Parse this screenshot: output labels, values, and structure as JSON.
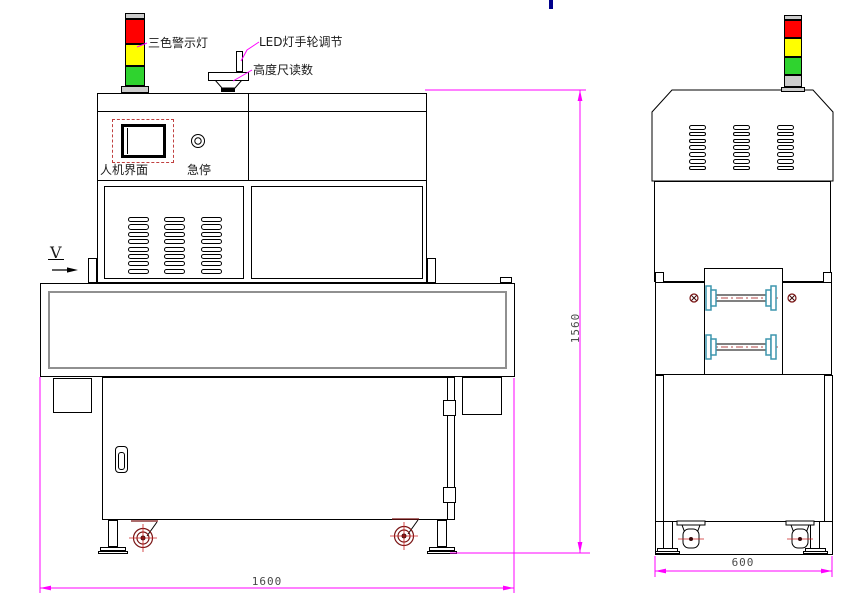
{
  "annotations": {
    "stack_light_label": "三色警示灯",
    "led_handwheel_label": "LED灯手轮调节",
    "height_scale_label": "高度尺读数",
    "hmi_label": "人机界面",
    "estop_label": "急停",
    "view_arrow_label": "V"
  },
  "dimensions": {
    "front_overall_width": "1600",
    "front_overall_height": "1560",
    "side_overall_width": "600"
  },
  "colors": {
    "dimension_line": "#ff00ff",
    "stack_light_red": "#ff0000",
    "stack_light_yellow": "#ffff00",
    "stack_light_green": "#2fd32f",
    "stack_light_gray": "#cccccc",
    "hmi_frame_red": "#c04040",
    "caster_dark_red": "#7a1414",
    "roller_flange_teal": "#3d95ad",
    "roller_centerline_red": "#b34747",
    "text_cursor_blue": "#00008b"
  }
}
